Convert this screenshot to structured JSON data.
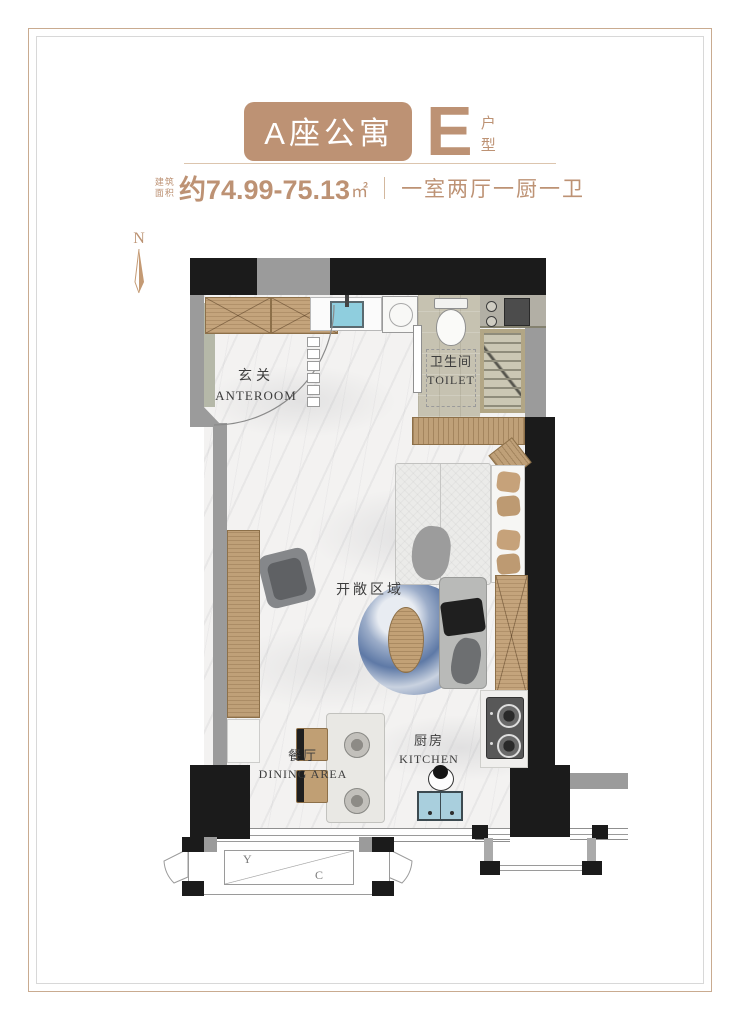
{
  "header": {
    "building_badge": "A座公寓",
    "unit_letter": "E",
    "unit_suffix_1": "户",
    "unit_suffix_2": "型",
    "area_label_1": "建筑",
    "area_label_2": "面积",
    "area_value": "约74.99-75.13",
    "area_unit": "㎡",
    "layout_desc": "一室两厅一厨一卫",
    "accent_color": "#bd9274"
  },
  "compass": {
    "label": "N"
  },
  "rooms": {
    "anteroom": {
      "zh": "玄关",
      "en": "ANTEROOM"
    },
    "toilet": {
      "zh": "卫生间",
      "en": "TOILET"
    },
    "open_area": {
      "zh": "开敞区域"
    },
    "dining": {
      "zh": "餐厅",
      "en": "DINING AREA"
    },
    "kitchen": {
      "zh": "厨房",
      "en": "KITCHEN"
    }
  },
  "equipment_platform": {
    "label_left": "Y",
    "label_right": "C"
  },
  "colors": {
    "wall_black": "#1b1b1b",
    "wall_gray": "#9b9b9b",
    "wood_tan": "#bfa078",
    "sink_blue": "#8fcede",
    "rug_blue": "#6d86b0",
    "floor_marble": "#f3f2f1",
    "floor_tile": "#c6c2b1"
  }
}
